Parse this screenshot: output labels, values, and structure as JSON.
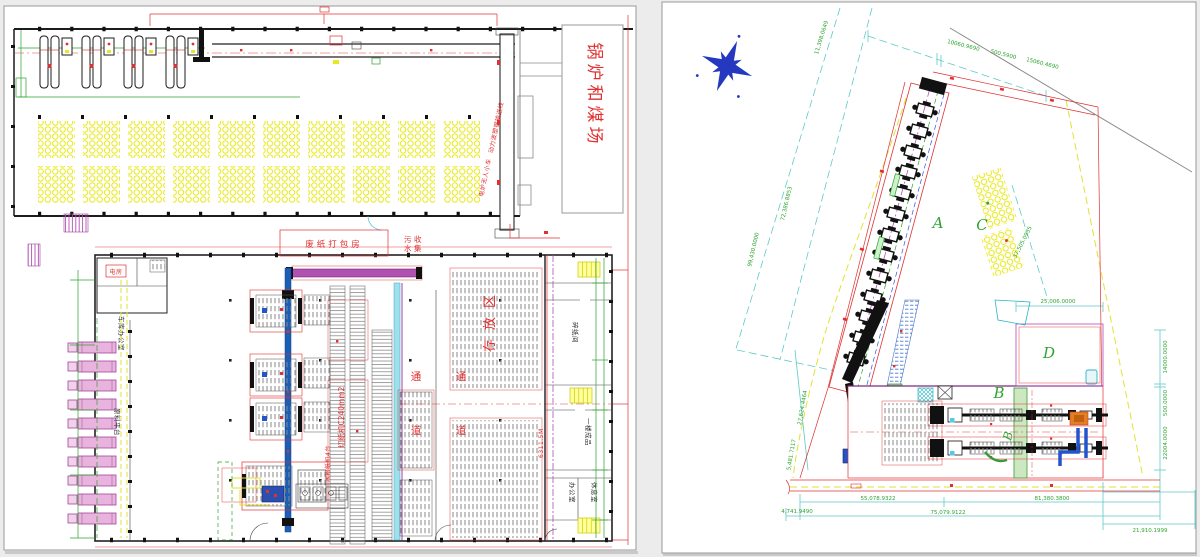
{
  "app": {
    "colors": {
      "cad_red": "#e03030",
      "dim_green": "#2fa32f",
      "boundary_cyan": "#5fc9c9",
      "road_yellow": "#e2e232",
      "conveyor_blue": "#1b5eb5",
      "conveyor_purple": "#b050b0",
      "truck_pink": "#e8b4de",
      "coal_yellow": "#e8e800"
    }
  },
  "left": {
    "title": "锅炉和煤场",
    "labels": {
      "conveyor_line": "动力波塑钢输送线",
      "furnace_cart": "电炉无人小车",
      "waste_packing": "废纸打包房",
      "sew1": "污",
      "sew2": "水",
      "sew3": "收",
      "sew4": "集",
      "electric_room": "电房",
      "garage_office": "车库办公室",
      "material_platform": "原料平台",
      "cutter": "切纸机C240mm2",
      "paper_machines": "水松纸机4台",
      "storage_zone": "存放区",
      "aisle1": "通",
      "aisle2": "道",
      "room_shred": "碎纸间",
      "room_finished": "一楼成品",
      "room_office": "办公室",
      "room_rest": "休息室",
      "red_note": "6311.5M"
    }
  },
  "right": {
    "areas": {
      "a": "A",
      "b": "B",
      "b2": "B",
      "c": "C",
      "d": "D"
    },
    "dims": {
      "t_diag": "11,398.0649",
      "top1": "10060.9690",
      "top2": "500.5900",
      "top3": "15060.4690",
      "left1": "99,430.0000",
      "left2": "72,386.8853",
      "left3": "27,624.4464",
      "left4": "5,481.7117",
      "mid": "37,505.0935",
      "d_width": "25,006.0000",
      "r1": "14000.0000",
      "r2": "500.0000",
      "r3": "22004.0000",
      "b1": "55,078.9322",
      "b2": "81,380.3800",
      "b3": "4,741.9490",
      "b4": "75,079.9122",
      "b5": "21,910.1999"
    }
  }
}
